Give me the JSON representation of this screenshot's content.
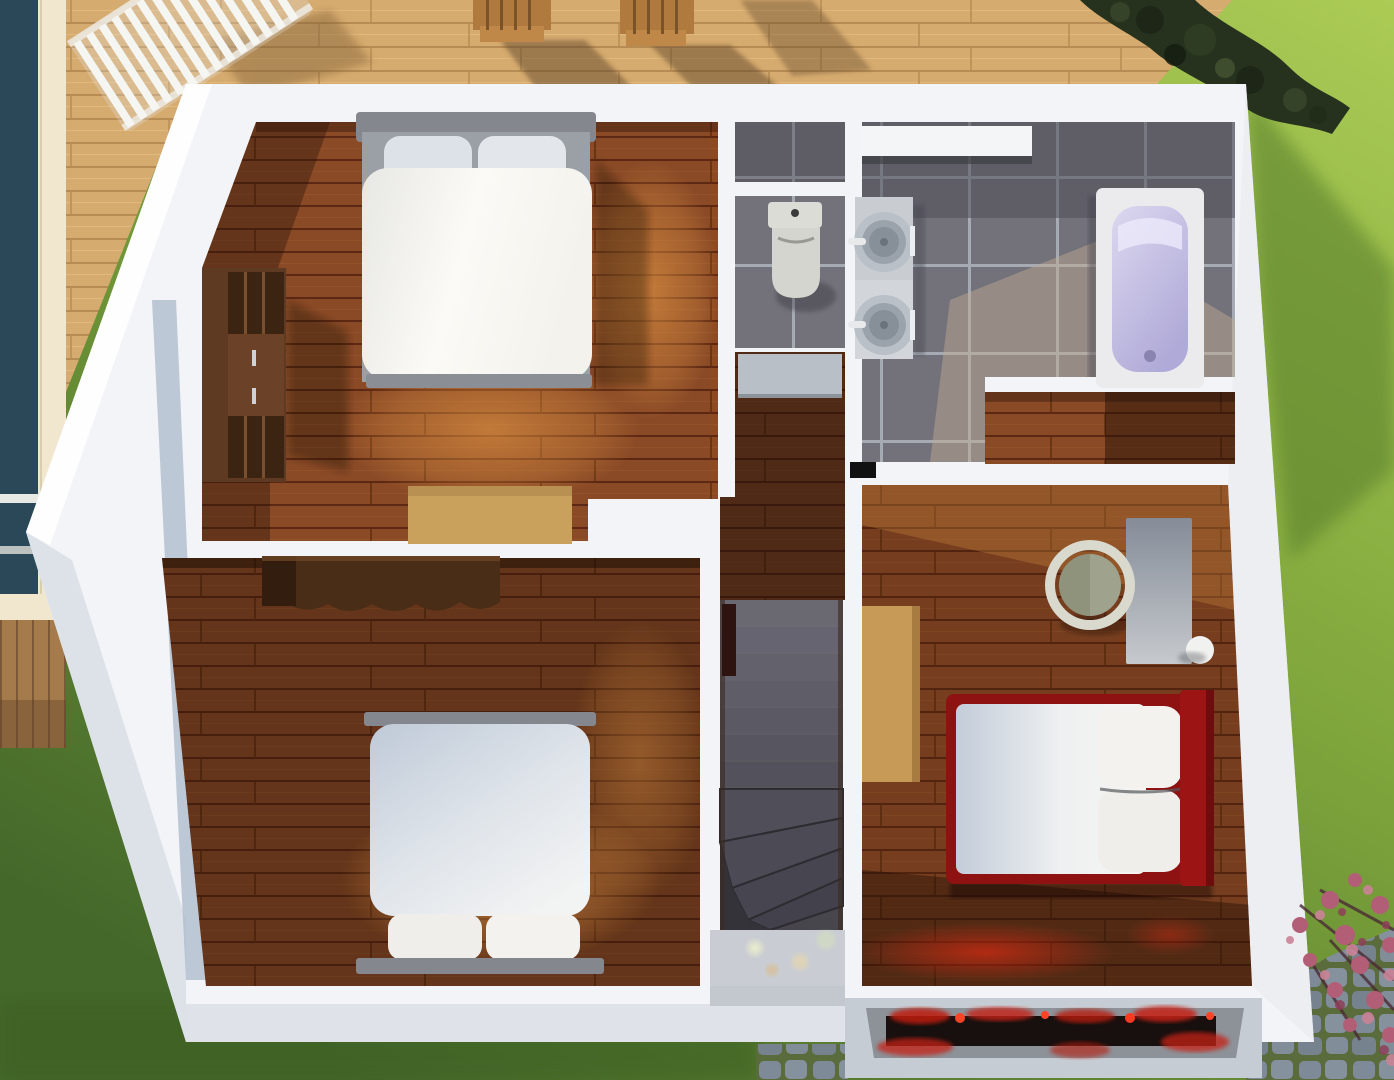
{
  "meta": {
    "image_type": "3d-architectural-floor-plan",
    "view": "top-down-upper-floor",
    "visible_text": "none"
  },
  "palette": {
    "pool": "#24404f",
    "pool_edge": "#f0e7ce",
    "fence_wood": "#a57b4c",
    "deck_wood": "#d2a769",
    "grass_bright": "#abcb55",
    "grass_mid": "#7fa63c",
    "grass_dark": "#44682a",
    "grass_shadow": "#567d2a",
    "hedge": "#26321e",
    "wall_white": "#f2f4f7",
    "wall_shadow": "#dde2e9",
    "wall_inner_shadow": "#aebdcd",
    "floor_wood": "#8a4a26",
    "floor_wood_dark": "#572511",
    "sun_patch": "#e89a45",
    "tile_gray": "#73727b",
    "tile_grout": "#a6abb3",
    "tile_dark": "#4f4e57",
    "counter_gray": "#c9cdd2",
    "basin_rim": "#b9c0c7",
    "basin_bowl": "#878f98",
    "toilet_white": "#dcdcd6",
    "tub_rim": "#ebebee",
    "tub_inner": "#c0badf",
    "stair_step": "#615f66",
    "stair_dark": "#2e2c31",
    "hall_floor": "#c9cdd3",
    "bed_duvet": "#f6f5f1",
    "pillow": "#dde2e8",
    "bed_frame": "#84888e",
    "duvet_shadow": "#c3ccd9",
    "red_bed": "#8e1212",
    "red_headboard": "#9c1414",
    "red_glow": "#d21f10",
    "rug_tan": "#c9a05c",
    "desk_tan": "#c79a58",
    "desk_tan_edge": "#a87c41",
    "wardrobe_wood": "#5e3a22",
    "wardrobe_dark": "#3c2413",
    "dresser_wood": "#4a2d17",
    "chair_sage": "#9fa28d",
    "chair_frame": "#d9d9cd",
    "lamp_white": "#f1f1ef",
    "cobble_stone": "#7e8a97",
    "cobble_moss": "#5a6b3c",
    "planter_frame": "#c6ccd3",
    "planter_dark": "#17100f",
    "flower_pink": "#b25e77",
    "door_gray": "#b9bfc7"
  },
  "scene": {
    "rooms": [
      {
        "name": "bedroom-1",
        "position": "top-left",
        "floor": "dark-wood",
        "furniture": [
          "double-bed-white",
          "wardrobe-shelf",
          "tan-rug"
        ]
      },
      {
        "name": "bedroom-2",
        "position": "bottom-left",
        "floor": "dark-wood",
        "furniture": [
          "double-bed-white",
          "wavy-front-dresser"
        ]
      },
      {
        "name": "wc",
        "position": "top-center",
        "floor": "gray-tile",
        "furniture": [
          "toilet"
        ]
      },
      {
        "name": "bathroom",
        "position": "top-right",
        "floor": "gray-tile",
        "furniture": [
          "double-washbasin-counter",
          "bathtub-lavender"
        ]
      },
      {
        "name": "closet-niche",
        "position": "right-upper",
        "floor": "dark-wood",
        "furniture": []
      },
      {
        "name": "bedroom-3",
        "position": "right",
        "floor": "dark-wood",
        "furniture": [
          "double-bed-red-frame",
          "gray-desk",
          "sage-armchair",
          "ball-lamp",
          "tan-side-table"
        ]
      },
      {
        "name": "stair-hall",
        "position": "center",
        "floor": "gray",
        "furniture": [
          "winding-staircase",
          "wc-door"
        ]
      }
    ],
    "exterior": [
      "swimming-pool",
      "pool-coping",
      "wooden-fence",
      "wooden-deck",
      "sun-lounger",
      "deck-chairs",
      "hedge",
      "lawn",
      "cobblestone-path",
      "red-flower-planter",
      "pink-shrub"
    ]
  }
}
